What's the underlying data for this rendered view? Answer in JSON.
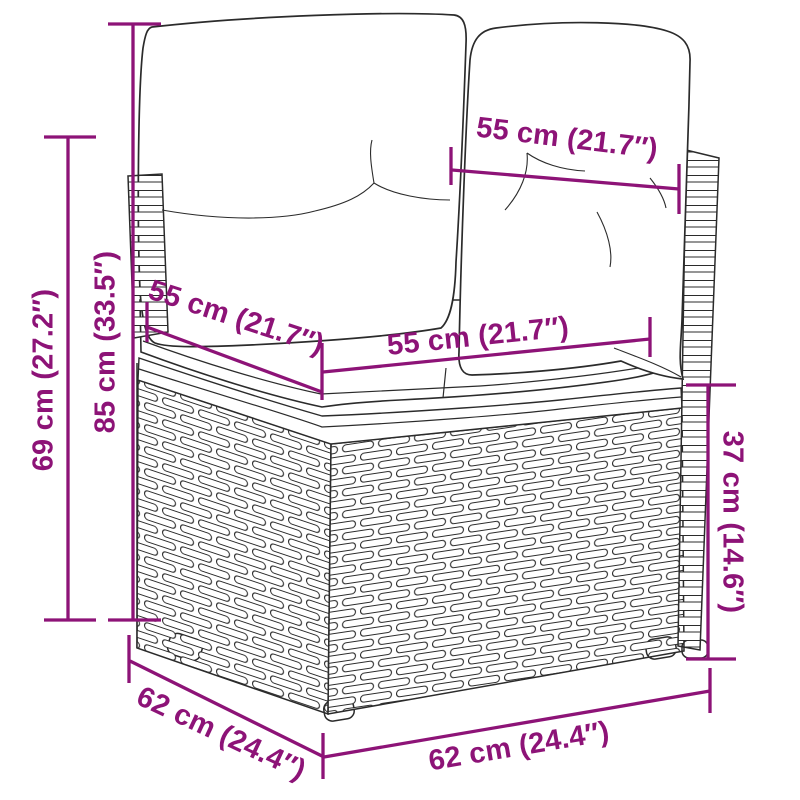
{
  "diagram": {
    "illustration": "rattan-corner-sofa-line-art",
    "accent_color": "#8D1377",
    "line_color": "#2b2b2b",
    "measurements": {
      "overall_height": "69 cm (27.2″)",
      "back_height": "85 cm (33.5″)",
      "back_cushion_width": "55 cm (21.7″)",
      "seat_depth": "55 cm (21.7″)",
      "seat_width": "55 cm (21.7″)",
      "base_height": "37 cm (14.6″)",
      "base_depth": "62 cm (24.4″)",
      "base_width": "62 cm (24.4″)"
    }
  }
}
